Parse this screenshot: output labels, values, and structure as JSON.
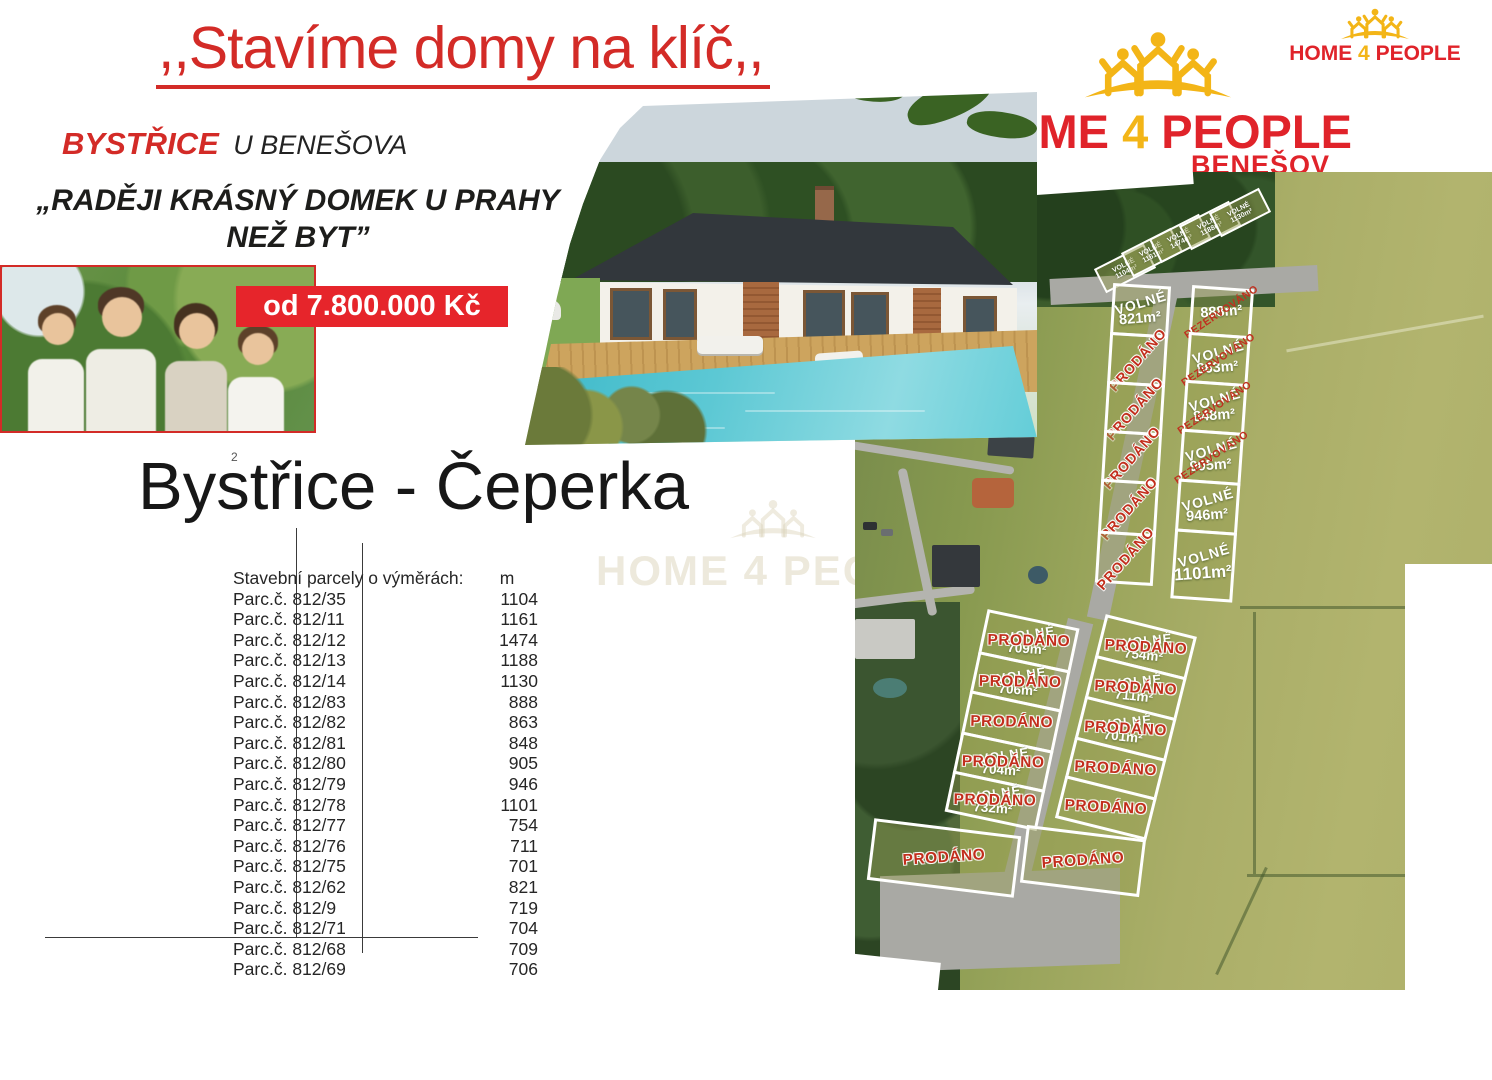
{
  "header": {
    "title": ",,Stavíme domy na klíč,,",
    "location_primary": "BYSTŘICE",
    "location_secondary": "U BENEŠOVA",
    "quote_line1": "„RADĚJI KRÁSNÝ DOMEK U PRAHY",
    "quote_line2": "NEŽ BYT”",
    "price_badge": "od 7.800.000 Kč"
  },
  "logo_main": {
    "home": "HOME",
    "four": "4",
    "people": "PEOPLE",
    "city": "BENEŠOV"
  },
  "logo_small": {
    "home": "HOME",
    "four": "4",
    "people": "PEOPLE"
  },
  "watermark": {
    "text": "HOME 4 PEOPLE"
  },
  "section": {
    "title": "Bystřice - Čeperka",
    "superscript": "2"
  },
  "table": {
    "header": {
      "label": "Stavební parcely o výměrách:",
      "unit": "m"
    },
    "rows": [
      {
        "parcel": "Parc.č. 812/35",
        "area": "1104"
      },
      {
        "parcel": "Parc.č. 812/11",
        "area": "1161"
      },
      {
        "parcel": "Parc.č. 812/12",
        "area": "1474"
      },
      {
        "parcel": "Parc.č. 812/13",
        "area": "1188"
      },
      {
        "parcel": "Parc.č. 812/14",
        "area": "1130"
      },
      {
        "parcel": "Parc.č. 812/83",
        "area": "888"
      },
      {
        "parcel": "Parc.č. 812/82",
        "area": "863"
      },
      {
        "parcel": "Parc.č. 812/81",
        "area": "848"
      },
      {
        "parcel": "Parc.č. 812/80",
        "area": "905"
      },
      {
        "parcel": "Parc.č. 812/79",
        "area": "946"
      },
      {
        "parcel": "Parc.č. 812/78",
        "area": "1101"
      },
      {
        "parcel": "Parc.č. 812/77",
        "area": "754"
      },
      {
        "parcel": "Parc.č. 812/76",
        "area": "711"
      },
      {
        "parcel": "Parc.č. 812/75",
        "area": "701"
      },
      {
        "parcel": "Parc.č. 812/62",
        "area": "821"
      },
      {
        "parcel": "Parc.č. 812/9",
        "area": "719"
      },
      {
        "parcel": "Parc.č. 812/71",
        "area": "704"
      },
      {
        "parcel": "Parc.č. 812/68",
        "area": "709"
      },
      {
        "parcel": "Parc.č. 812/69",
        "area": "706"
      }
    ]
  },
  "map": {
    "fan": [
      {
        "status": "VOLNÉ",
        "area": "1104m²"
      },
      {
        "status": "VOLNÉ",
        "area": "1161m²"
      },
      {
        "status": "VOLNÉ",
        "area": "1474m²"
      },
      {
        "status": "VOLNÉ",
        "area": "1188m²"
      },
      {
        "status": "VOLNÉ",
        "area": "1130m²"
      }
    ],
    "upper_left": [
      {
        "status": "VOLNÉ",
        "area": "821m²"
      },
      {
        "overlay": "PRODÁNO"
      },
      {
        "overlay": "PRODÁNO"
      },
      {
        "overlay": "PRODÁNO"
      },
      {
        "overlay": "PRODÁNO"
      },
      {
        "overlay": "PRODÁNO"
      }
    ],
    "upper_right": [
      {
        "area": "888m²",
        "overlay": "REZERVOVÁNO"
      },
      {
        "status": "VOLNÉ",
        "area": "863m²",
        "overlay": "REZERVOVÁNO"
      },
      {
        "status": "VOLNÉ",
        "area": "848m²",
        "overlay": "REZERVOVÁNO"
      },
      {
        "status": "VOLNÉ",
        "area": "905m²",
        "overlay": "REZERVOVÁNO"
      },
      {
        "status": "VOLNÉ",
        "area": "946m²"
      },
      {
        "status": "VOLNÉ",
        "area": "1101m²"
      }
    ],
    "lower_left": [
      {
        "status": "VOLNÉ",
        "area": "709m²",
        "overlay": "PRODÁNO"
      },
      {
        "status": "VOLNÉ",
        "area": "706m²",
        "overlay": "PRODÁNO"
      },
      {
        "overlay": "PRODÁNO"
      },
      {
        "status": "VOLNÉ",
        "area": "704m²",
        "overlay": "PRODÁNO"
      },
      {
        "status": "VOLNÉ",
        "area": "732m²",
        "overlay": "PRODÁNO"
      },
      {
        "overlay": "PRODÁNO"
      }
    ],
    "lower_right": [
      {
        "status": "VOLNÉ",
        "area": "754m²",
        "overlay": "PRODÁNO"
      },
      {
        "status": "VOLNÉ",
        "area": "711m²",
        "overlay": "PRODÁNO"
      },
      {
        "status": "VOLNÉ",
        "area": "701m²",
        "overlay": "PRODÁNO"
      },
      {
        "overlay": "PRODÁNO"
      },
      {
        "overlay": "PRODÁNO"
      },
      {
        "overlay": "PRODÁNO"
      }
    ]
  },
  "colors": {
    "accent_red": "#d32b27",
    "price_red": "#e6252b",
    "logo_yellow": "#f3b517",
    "sold_red": "#c22e1c",
    "free_white": "#ffffff",
    "road_gray": "#a9a9a4"
  }
}
